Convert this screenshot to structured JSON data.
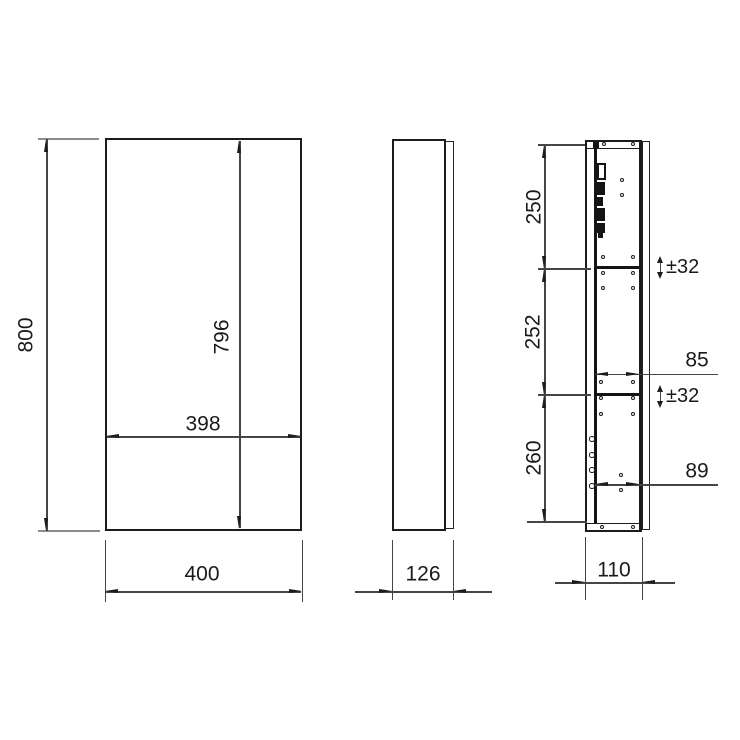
{
  "views": {
    "front": {
      "overall_height": "800",
      "inner_height": "796",
      "inner_width": "398",
      "overall_width": "400"
    },
    "side": {
      "overall_depth": "126"
    },
    "section": {
      "top_compartment": "250",
      "middle_compartment": "252",
      "bottom_compartment": "260",
      "shelf_tolerance_upper": "±32",
      "shelf_tolerance_lower": "±32",
      "inner_depth_upper": "85",
      "inner_depth_lower": "89",
      "carcass_depth": "110"
    }
  }
}
